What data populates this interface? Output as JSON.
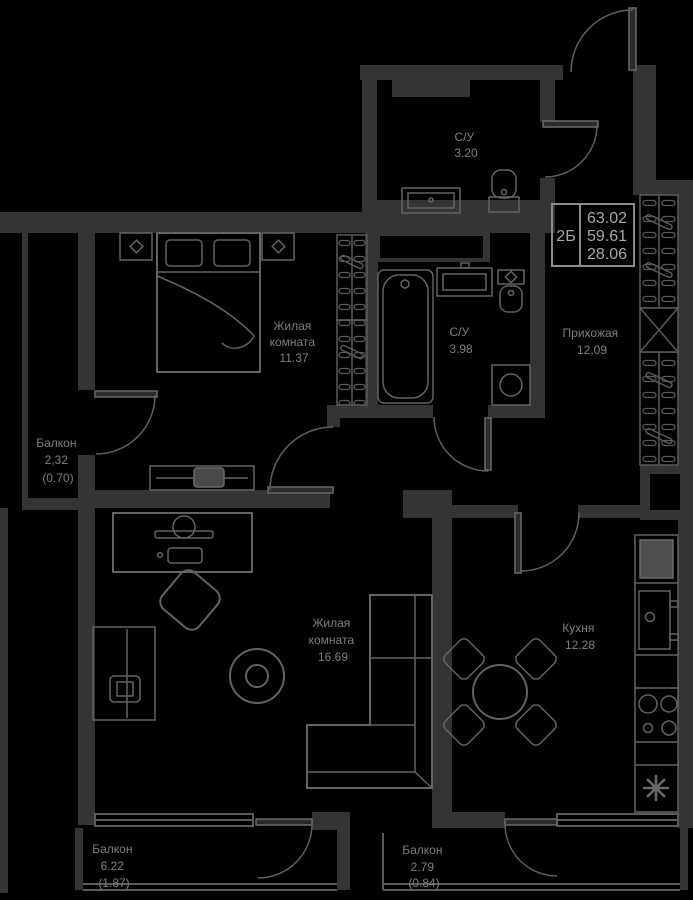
{
  "palette": {
    "background": "#000000",
    "walls": "#343434",
    "furniture_stroke": "#636363",
    "label_text": "#7f7f7f",
    "info_text": "#a8a8a8"
  },
  "info_box": {
    "unit_type": "2Б",
    "total_area": "63.02",
    "living_area": "59.61",
    "extra_area": "28.06"
  },
  "rooms": {
    "bathroom_top": {
      "name": "С/У",
      "area": "3.20"
    },
    "bedroom": {
      "name1": "Жилая",
      "name2": "комната",
      "area": "11.37"
    },
    "bathroom_main": {
      "name": "С/У",
      "area": "3.98"
    },
    "hallway": {
      "name": "Прихожая",
      "area": "12,09"
    },
    "balcony_left": {
      "name": "Балкон",
      "area": "2,32",
      "coef": "(0.70)"
    },
    "living_room": {
      "name1": "Жилая",
      "name2": "комната",
      "area": "16.69"
    },
    "kitchen": {
      "name": "Кухня",
      "area": "12.28"
    },
    "balcony_bottom_left": {
      "name": "Балкон",
      "area": "6.22",
      "coef": "(1.87)"
    },
    "balcony_bottom_right": {
      "name": "Балкон",
      "area": "2.79",
      "coef": "(0.84)"
    }
  }
}
